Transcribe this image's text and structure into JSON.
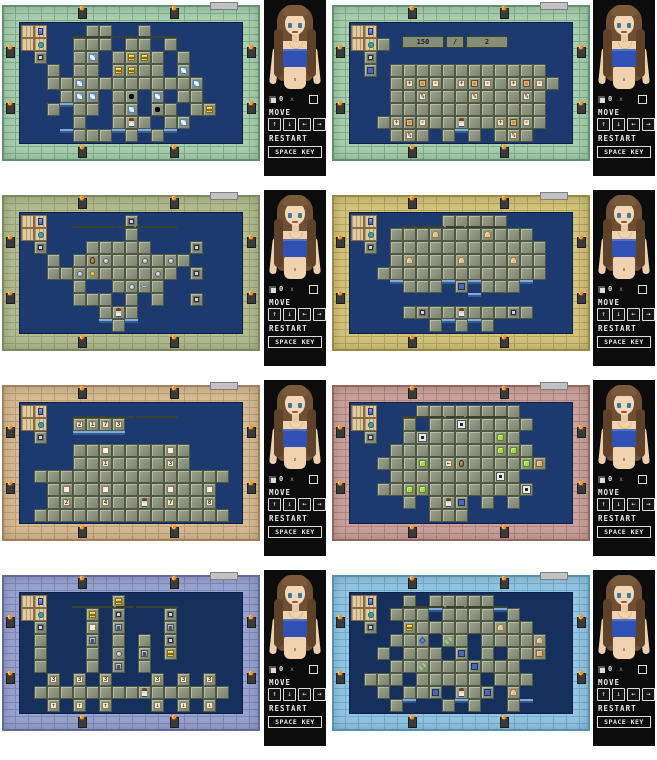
{
  "sidebar": {
    "counter": {
      "count": "0",
      "times": "x"
    },
    "move_label": "MOVE",
    "arrows": {
      "up": "↑",
      "down": "↓",
      "left": "←",
      "right": "→"
    },
    "restart_label": "RESTART",
    "space_key_label": "SPACE KEY"
  },
  "tile_legend": {
    "plus": "+",
    "minus": "-",
    "percent": "%",
    "arrow_up": "↑",
    "arrow_down": "↓",
    "arrow_left": "←"
  },
  "panels": [
    {
      "frame": {
        "light": "#a8cfae",
        "dark": "#5f926e",
        "line": "#7fae8c"
      },
      "board_bg": "#1c3a6d",
      "hud": null,
      "grid": [
        "JF...tt..t.......",
        "JO..ttt.tt.t.....",
        ".b..ti.tyyt.t....",
        "..t.tt.yytt.i....",
        "..ttitttttttti...",
        "...tii.th.i.tt...",
        "..t~tt.ti.ht.ty..",
        "....t..tct.ti....",
        "...~ttt~t~t~....."
      ]
    },
    {
      "frame": {
        "light": "#a8cfae",
        "dark": "#5f926e",
        "line": "#7fae8c"
      },
      "board_bg": "#1c3a6d",
      "hud": {
        "left": "150",
        "divider": "/",
        "right": "2"
      },
      "grid": [
        "JF...............",
        "JOt..............",
        ".b...............",
        ".u.tttttttttttt..",
        "...t+w-t+w-t+w-t.",
        "...tt%ttt%ttt%t..",
        "...tttttttttttt..",
        "..t+w-ttctt+w-t..",
        "...t%t.t~t.t%t..."
      ]
    },
    {
      "frame": {
        "light": "#b2bc90",
        "dark": "#7c885e",
        "line": "#97a372"
      },
      "board_bg": "#1c3a6d",
      "hud": null,
      "grid": [
        "JF......b........",
        "JO......t........",
        ".b...ttttt...b...",
        "..t.tpottotot....",
        "..ttofttttot.b...",
        "....t..tolt......",
        "....ttt.t.t..b...",
        "......tct........",
        "......~t~........"
      ]
    },
    {
      "frame": {
        "light": "#d3c47c",
        "dark": "#9a8a46",
        "line": "#b5a65e"
      },
      "board_bg": "#1c3a6d",
      "hud": null,
      "grid": [
        "JF.....ttttt.....",
        "JO.tttdtttdttt...",
        ".b.tttttttttttt..",
        "...tdtttdtttdtt..",
        "..ttttttttttttt..",
        "...~ttt~u~ttt~...",
        ".........~.......",
        "....tbttctttbt...",
        "......t~t~t......"
      ]
    },
    {
      "frame": {
        "light": "#d6bb93",
        "dark": "#a3805a",
        "line": "#bb9f74"
      },
      "board_bg": "#1c3a6d",
      "hud": null,
      "grid": [
        "JF...............",
        "JO..2173.........",
        ".b..~~~~.........",
        "....ttnttttnt....",
        "....tt1tttt3t....",
        ".ttttttttttttttt.",
        "..tnttnttttnttn..",
        "..t2tt4ttct7tt8..",
        ".ttttttttttttttt."
      ]
    },
    {
      "frame": {
        "light": "#cba29b",
        "dark": "#96655f",
        "line": "#b0847d"
      },
      "board_bg": "#1c3a6d",
      "hud": null,
      "grid": [
        "JF...tttttttt....",
        "JO..t.ttmttttt...",
        ".b..tmtttttgt....",
        "...ttttttttggt...",
        "..tttgt<pttttgk..",
        "...ttttttttmt....",
        "..ttggtttttttm...",
        "....t.tcu.t.t....",
        "......ttt........"
      ]
    },
    {
      "frame": {
        "light": "#99a3cf",
        "dark": "#5f6b9e",
        "line": "#7d88b5"
      },
      "board_bg": "#16305e",
      "hud": null,
      "grid": [
        "JF.....y.........",
        "JO...y.b...b.....",
        ".b...n.s...s.....",
        ".t...s.t.t.b.....",
        ".t...t.o.s.y.....",
        ".t...t.s.t.......",
        "..3.3.3...3.3.3..",
        ".ttttttttctttttt.",
        "..a.a.a...v.v.v.."
      ]
    },
    {
      "frame": {
        "light": "#93c6e3",
        "dark": "#5590b5",
        "line": "#74aacb"
      },
      "board_bg": "#16305e",
      "hud": null,
      "grid": [
        "JF..t.ttttt......",
        "JO.ttt~tttt~t....",
        ".b..yttttttdtt...",
        "...tte.rt.ttttd..",
        "..t.ttt.u.t.ttk..",
        "...ttrtttuttt....",
        ".ttt.ttttt.ttt...",
        "..t.ttu.ctu.d....",
        "...t~..t~t..t~..."
      ]
    }
  ]
}
